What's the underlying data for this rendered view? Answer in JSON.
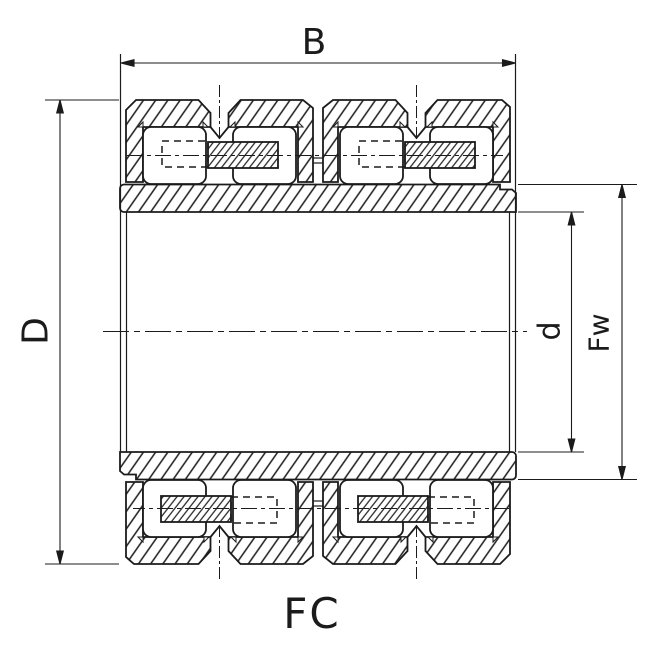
{
  "drawing": {
    "series_label": "FC",
    "dimensions": {
      "width": {
        "label": "B",
        "meaning": "bearing-width"
      },
      "outer_diameter": {
        "label": "D",
        "meaning": "outside-diameter"
      },
      "bore_diameter": {
        "label": "d",
        "meaning": "bore-diameter"
      },
      "raceway_diameter": {
        "label": "Fw",
        "meaning": "inner-raceway-diameter"
      }
    },
    "colors": {
      "ink": "#1b1b1b",
      "paper": "#ffffff"
    }
  }
}
